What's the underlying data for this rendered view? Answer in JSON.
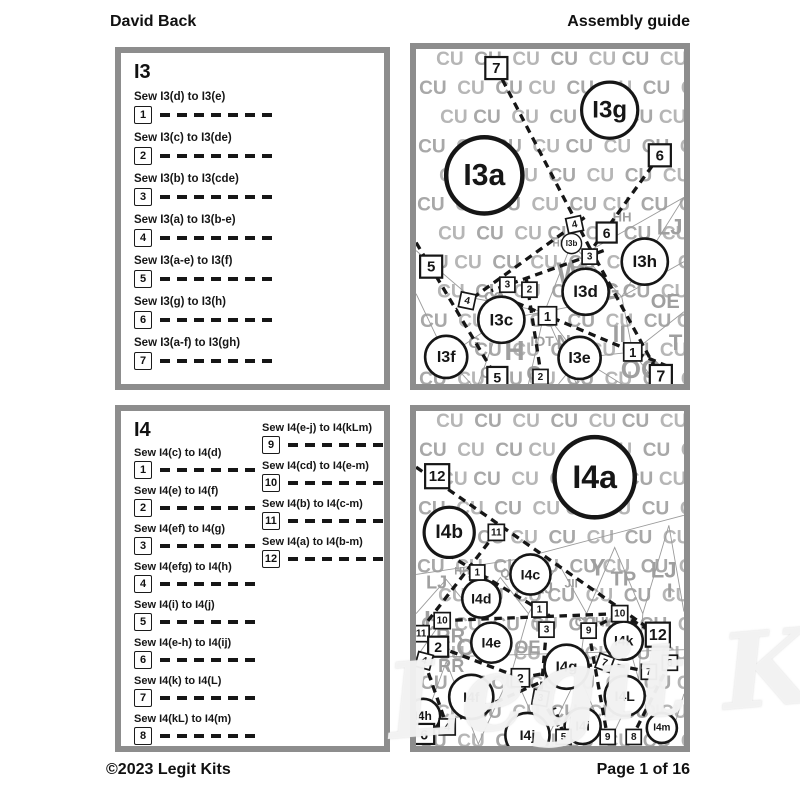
{
  "header": {
    "left": "David Back",
    "right": "Assembly guide"
  },
  "footer": {
    "left": "©2023 Legit Kits",
    "right": "Page 1 of 16"
  },
  "watermark": "Legit Kits",
  "i3": {
    "title": "I3",
    "steps": [
      {
        "num": "1",
        "text": "Sew I3(d) to I3(e)"
      },
      {
        "num": "2",
        "text": "Sew I3(c) to I3(de)"
      },
      {
        "num": "3",
        "text": "Sew I3(b) to I3(cde)"
      },
      {
        "num": "4",
        "text": "Sew I3(a) to I3(b-e)"
      },
      {
        "num": "5",
        "text": "Sew I3(a-e) to I3(f)"
      },
      {
        "num": "6",
        "text": "Sew I3(g) to I3(h)"
      },
      {
        "num": "7",
        "text": "Sew I3(a-f) to I3(gh)"
      }
    ]
  },
  "i4": {
    "title": "I4",
    "steps_left": [
      {
        "num": "1",
        "text": "Sew I4(c) to I4(d)"
      },
      {
        "num": "2",
        "text": "Sew I4(e) to I4(f)"
      },
      {
        "num": "3",
        "text": "Sew I4(ef) to I4(g)"
      },
      {
        "num": "4",
        "text": "Sew I4(efg) to I4(h)"
      },
      {
        "num": "5",
        "text": "Sew I4(i) to I4(j)"
      },
      {
        "num": "6",
        "text": "Sew I4(e-h) to I4(ij)"
      },
      {
        "num": "7",
        "text": "Sew I4(k) to I4(L)"
      },
      {
        "num": "8",
        "text": "Sew I4(kL) to I4(m)"
      }
    ],
    "steps_right": [
      {
        "num": "9",
        "text": "Sew I4(e-j) to I4(kLm)"
      },
      {
        "num": "10",
        "text": "Sew I4(cd) to I4(e-m)"
      },
      {
        "num": "11",
        "text": "Sew I4(b) to I4(c-m)"
      },
      {
        "num": "12",
        "text": "Sew I4(a) to I4(b-m)"
      }
    ]
  },
  "i3_diagram": {
    "bg_letter": "CU",
    "scatter": [
      {
        "t": "HH",
        "x": 196,
        "y": 172,
        "fs": 13
      },
      {
        "t": "LJ",
        "x": 240,
        "y": 185,
        "fs": 22
      },
      {
        "t": "HH",
        "x": 136,
        "y": 197,
        "fs": 10
      },
      {
        "t": "W",
        "x": 140,
        "y": 234,
        "fs": 30
      },
      {
        "t": "CO",
        "x": 68,
        "y": 251,
        "fs": 13
      },
      {
        "t": "G",
        "x": 186,
        "y": 249,
        "fs": 22
      },
      {
        "t": "OE",
        "x": 234,
        "y": 258,
        "fs": 20
      },
      {
        "t": "II",
        "x": 196,
        "y": 292,
        "fs": 24
      },
      {
        "t": "IOT",
        "x": 114,
        "y": 296,
        "fs": 14
      },
      {
        "t": "N",
        "x": 140,
        "y": 299,
        "fs": 20
      },
      {
        "t": "T",
        "x": 252,
        "y": 300,
        "fs": 22
      },
      {
        "t": "G",
        "x": 52,
        "y": 298,
        "fs": 16
      },
      {
        "t": "H",
        "x": 88,
        "y": 310,
        "fs": 28
      },
      {
        "t": "CF",
        "x": 64,
        "y": 328,
        "fs": 16
      },
      {
        "t": "Q",
        "x": 110,
        "y": 330,
        "fs": 20
      },
      {
        "t": "OO",
        "x": 204,
        "y": 328,
        "fs": 26
      }
    ],
    "edges": [
      [
        [
          0,
          201
        ],
        [
          55,
          248
        ],
        [
          128,
          262
        ],
        [
          205,
          247
        ],
        [
          267,
          148
        ]
      ],
      [
        [
          0,
          244
        ],
        [
          30,
          307
        ],
        [
          55,
          334
        ]
      ],
      [
        [
          30,
          307
        ],
        [
          85,
          270
        ]
      ],
      [
        [
          85,
          270
        ],
        [
          62,
          334
        ]
      ],
      [
        [
          85,
          270
        ],
        [
          128,
          262
        ]
      ],
      [
        [
          128,
          262
        ],
        [
          112,
          334
        ]
      ],
      [
        [
          128,
          262
        ],
        [
          160,
          334
        ]
      ],
      [
        [
          128,
          262
        ],
        [
          163,
          308
        ]
      ],
      [
        [
          163,
          308
        ],
        [
          142,
          334
        ]
      ],
      [
        [
          163,
          308
        ],
        [
          205,
          334
        ]
      ],
      [
        [
          163,
          308
        ],
        [
          216,
          302
        ]
      ],
      [
        [
          205,
          247
        ],
        [
          216,
          302
        ]
      ],
      [
        [
          216,
          302
        ],
        [
          240,
          334
        ]
      ],
      [
        [
          216,
          302
        ],
        [
          267,
          262
        ]
      ],
      [
        [
          205,
          247
        ],
        [
          267,
          212
        ]
      ],
      [
        [
          155,
          194
        ],
        [
          205,
          247
        ]
      ],
      [
        [
          155,
          194
        ],
        [
          128,
          262
        ]
      ],
      [
        [
          175,
          200
        ],
        [
          267,
          148
        ]
      ]
    ],
    "seams": [
      [
        [
          80,
          19
        ],
        [
          173,
          198
        ]
      ],
      [
        [
          173,
          198
        ],
        [
          244,
          328
        ]
      ],
      [
        [
          243,
          106
        ],
        [
          175,
          200
        ]
      ],
      [
        [
          0,
          193
        ],
        [
          81,
          329
        ]
      ],
      [
        [
          168,
          168
        ],
        [
          40,
          260
        ]
      ],
      [
        [
          187,
          201
        ],
        [
          75,
          241
        ]
      ],
      [
        [
          110,
          230
        ],
        [
          126,
          334
        ]
      ],
      [
        [
          100,
          253
        ],
        [
          250,
          316
        ]
      ]
    ],
    "circles": [
      {
        "label": "I3a",
        "x": 68,
        "y": 126,
        "r": 38,
        "fs": 30
      },
      {
        "label": "I3g",
        "x": 193,
        "y": 61,
        "r": 28,
        "fs": 24
      },
      {
        "label": "I3b",
        "x": 155,
        "y": 194,
        "r": 10,
        "fs": 8
      },
      {
        "label": "I3h",
        "x": 228,
        "y": 212,
        "r": 23,
        "fs": 17
      },
      {
        "label": "I3d",
        "x": 169,
        "y": 242,
        "r": 23,
        "fs": 17
      },
      {
        "label": "I3c",
        "x": 85,
        "y": 270,
        "r": 23,
        "fs": 17
      },
      {
        "label": "I3f",
        "x": 30,
        "y": 307,
        "r": 21,
        "fs": 16
      },
      {
        "label": "I3e",
        "x": 163,
        "y": 308,
        "r": 21,
        "fs": 16
      }
    ],
    "squares": [
      {
        "label": "7",
        "x": 80,
        "y": 19,
        "s": 22,
        "fs": 15
      },
      {
        "label": "6",
        "x": 243,
        "y": 106,
        "s": 22,
        "fs": 15
      },
      {
        "label": "5",
        "x": 15,
        "y": 217,
        "s": 22,
        "fs": 15
      },
      {
        "label": "4",
        "x": 158,
        "y": 175,
        "s": 15,
        "fs": 10,
        "rot": -12
      },
      {
        "label": "6",
        "x": 190,
        "y": 183,
        "s": 20,
        "fs": 14
      },
      {
        "label": "3",
        "x": 173,
        "y": 207,
        "s": 15,
        "fs": 10
      },
      {
        "label": "3",
        "x": 91,
        "y": 235,
        "s": 15,
        "fs": 10
      },
      {
        "label": "2",
        "x": 113,
        "y": 240,
        "s": 15,
        "fs": 10
      },
      {
        "label": "4",
        "x": 51,
        "y": 251,
        "s": 15,
        "fs": 10,
        "rot": 12
      },
      {
        "label": "1",
        "x": 131,
        "y": 266,
        "s": 18,
        "fs": 13
      },
      {
        "label": "1",
        "x": 216,
        "y": 302,
        "s": 18,
        "fs": 13
      },
      {
        "label": "2",
        "x": 124,
        "y": 327,
        "s": 15,
        "fs": 10
      },
      {
        "label": "5",
        "x": 81,
        "y": 327,
        "s": 20,
        "fs": 14
      },
      {
        "label": "7",
        "x": 244,
        "y": 326,
        "s": 22,
        "fs": 16
      }
    ]
  },
  "i4_diagram": {
    "bg_letter": "CU",
    "scatter": [
      {
        "t": "HH",
        "x": 38,
        "y": 163,
        "fs": 11
      },
      {
        "t": "QE",
        "x": 84,
        "y": 166,
        "fs": 12
      },
      {
        "t": "W",
        "x": 52,
        "y": 180,
        "fs": 22
      },
      {
        "t": "Y",
        "x": 173,
        "y": 164,
        "fs": 24
      },
      {
        "t": "TP",
        "x": 194,
        "y": 174,
        "fs": 20
      },
      {
        "t": "LJ",
        "x": 234,
        "y": 166,
        "fs": 22
      },
      {
        "t": "LJ",
        "x": 10,
        "y": 177,
        "fs": 18
      },
      {
        "t": "JII",
        "x": 148,
        "y": 176,
        "fs": 12
      },
      {
        "t": "R",
        "x": 68,
        "y": 188,
        "fs": 20
      },
      {
        "t": "LJ",
        "x": 118,
        "y": 182,
        "fs": 16
      },
      {
        "t": "I",
        "x": 8,
        "y": 216,
        "fs": 24
      },
      {
        "t": "RR",
        "x": 20,
        "y": 231,
        "fs": 20
      },
      {
        "t": "OE",
        "x": 40,
        "y": 244,
        "fs": 24
      },
      {
        "t": "TP",
        "x": 116,
        "y": 220,
        "fs": 16
      },
      {
        "t": "CC",
        "x": 158,
        "y": 215,
        "fs": 14
      },
      {
        "t": "HH",
        "x": 178,
        "y": 215,
        "fs": 14
      },
      {
        "t": "RR",
        "x": 22,
        "y": 260,
        "fs": 18
      },
      {
        "t": "OE",
        "x": 98,
        "y": 242,
        "fs": 18
      },
      {
        "t": "RR",
        "x": 148,
        "y": 246,
        "fs": 14
      },
      {
        "t": "Q",
        "x": 194,
        "y": 280,
        "fs": 18
      },
      {
        "t": "OL",
        "x": 228,
        "y": 302,
        "fs": 14
      },
      {
        "t": "I",
        "x": 250,
        "y": 186,
        "fs": 20
      },
      {
        "t": "CO",
        "x": 236,
        "y": 233,
        "fs": 10
      }
    ],
    "edges": [
      [
        [
          0,
          163
        ],
        [
          100,
          148
        ],
        [
          267,
          104
        ]
      ],
      [
        [
          0,
          202
        ],
        [
          30,
          168
        ],
        [
          58,
          202
        ],
        [
          84,
          166
        ],
        [
          112,
          202
        ],
        [
          142,
          152
        ],
        [
          170,
          202
        ],
        [
          198,
          136
        ],
        [
          226,
          202
        ],
        [
          252,
          114
        ],
        [
          267,
          200
        ]
      ],
      [
        [
          0,
          332
        ],
        [
          30,
          250
        ],
        [
          62,
          332
        ],
        [
          96,
          258
        ],
        [
          128,
          332
        ],
        [
          162,
          262
        ],
        [
          192,
          332
        ],
        [
          222,
          268
        ],
        [
          252,
          332
        ],
        [
          267,
          282
        ]
      ],
      [
        [
          0,
          246
        ],
        [
          267,
          238
        ]
      ],
      [
        [
          112,
          202
        ],
        [
          96,
          258
        ]
      ],
      [
        [
          170,
          202
        ],
        [
          162,
          262
        ]
      ],
      [
        [
          226,
          202
        ],
        [
          222,
          268
        ]
      ],
      [
        [
          26,
          209
        ],
        [
          0,
          246
        ]
      ],
      [
        [
          203,
          202
        ],
        [
          222,
          268
        ]
      ]
    ],
    "seams": [
      [
        [
          0,
          56
        ],
        [
          241,
          223
        ]
      ],
      [
        [
          80,
          121
        ],
        [
          2,
          222
        ]
      ],
      [
        [
          26,
          209
        ],
        [
          203,
          202
        ]
      ],
      [
        [
          203,
          202
        ],
        [
          241,
          223
        ]
      ],
      [
        [
          20,
          136
        ],
        [
          133,
          204
        ]
      ],
      [
        [
          172,
          219
        ],
        [
          203,
          202
        ]
      ],
      [
        [
          172,
          219
        ],
        [
          191,
          326
        ]
      ],
      [
        [
          253,
          251
        ],
        [
          217,
          322
        ]
      ],
      [
        [
          188,
          251
        ],
        [
          232,
          260
        ]
      ],
      [
        [
          8,
          322
        ],
        [
          125,
          270
        ]
      ],
      [
        [
          147,
          322
        ],
        [
          138,
          296
        ]
      ],
      [
        [
          8,
          249
        ],
        [
          31,
          315
        ]
      ],
      [
        [
          130,
          218
        ],
        [
          124,
          286
        ]
      ],
      [
        [
          22,
          235
        ],
        [
          104,
          266
        ]
      ],
      [
        [
          104,
          266
        ],
        [
          188,
          251
        ]
      ],
      [
        [
          124,
          286
        ],
        [
          147,
          322
        ]
      ]
    ],
    "circles": [
      {
        "label": "I4a",
        "x": 178,
        "y": 66,
        "r": 40,
        "fs": 32
      },
      {
        "label": "I4b",
        "x": 33,
        "y": 121,
        "r": 25,
        "fs": 19
      },
      {
        "label": "I4c",
        "x": 114,
        "y": 163,
        "r": 20,
        "fs": 14
      },
      {
        "label": "I4d",
        "x": 65,
        "y": 187,
        "r": 19,
        "fs": 14
      },
      {
        "label": "I4e",
        "x": 75,
        "y": 231,
        "r": 20,
        "fs": 14
      },
      {
        "label": "I4f",
        "x": 55,
        "y": 285,
        "r": 22,
        "fs": 14
      },
      {
        "label": "I4g",
        "x": 150,
        "y": 255,
        "r": 22,
        "fs": 15
      },
      {
        "label": "I4h",
        "x": 7,
        "y": 304,
        "r": 17,
        "fs": 12
      },
      {
        "label": "I4i",
        "x": 166,
        "y": 314,
        "r": 18,
        "fs": 13
      },
      {
        "label": "I4j",
        "x": 111,
        "y": 323,
        "r": 22,
        "fs": 14
      },
      {
        "label": "I4k",
        "x": 207,
        "y": 229,
        "r": 19,
        "fs": 14
      },
      {
        "label": "I4L",
        "x": 208,
        "y": 284,
        "r": 20,
        "fs": 14
      },
      {
        "label": "I4m",
        "x": 245,
        "y": 316,
        "r": 15,
        "fs": 10
      }
    ],
    "squares": [
      {
        "label": "12",
        "x": 21,
        "y": 65,
        "s": 24,
        "fs": 15
      },
      {
        "label": "11",
        "x": 80,
        "y": 121,
        "s": 16,
        "fs": 10
      },
      {
        "label": "1",
        "x": 61,
        "y": 161,
        "s": 15,
        "fs": 10
      },
      {
        "label": "1",
        "x": 123,
        "y": 198,
        "s": 15,
        "fs": 10
      },
      {
        "label": "10",
        "x": 26,
        "y": 209,
        "s": 16,
        "fs": 10
      },
      {
        "label": "10",
        "x": 203,
        "y": 202,
        "s": 16,
        "fs": 10
      },
      {
        "label": "11",
        "x": 5,
        "y": 222,
        "s": 16,
        "fs": 10
      },
      {
        "label": "12",
        "x": 241,
        "y": 223,
        "s": 24,
        "fs": 16
      },
      {
        "label": "2",
        "x": 22,
        "y": 235,
        "s": 20,
        "fs": 14
      },
      {
        "label": "3",
        "x": 130,
        "y": 218,
        "s": 15,
        "fs": 10
      },
      {
        "label": "9",
        "x": 172,
        "y": 219,
        "s": 15,
        "fs": 10
      },
      {
        "label": "4",
        "x": 8,
        "y": 249,
        "s": 15,
        "fs": 10,
        "rot": 15
      },
      {
        "label": "8",
        "x": 253,
        "y": 251,
        "s": 15,
        "fs": 10
      },
      {
        "label": "7",
        "x": 188,
        "y": 251,
        "s": 15,
        "fs": 10,
        "rot": 20
      },
      {
        "label": "7",
        "x": 232,
        "y": 260,
        "s": 15,
        "fs": 10
      },
      {
        "label": "2",
        "x": 104,
        "y": 266,
        "s": 18,
        "fs": 12
      },
      {
        "label": "3",
        "x": 124,
        "y": 286,
        "s": 15,
        "fs": 10,
        "rot": 10
      },
      {
        "label": "4",
        "x": 31,
        "y": 315,
        "s": 16,
        "fs": 11
      },
      {
        "label": "6",
        "x": 8,
        "y": 322,
        "s": 20,
        "fs": 14
      },
      {
        "label": "5",
        "x": 147,
        "y": 325,
        "s": 15,
        "fs": 10
      },
      {
        "label": "9",
        "x": 191,
        "y": 325,
        "s": 15,
        "fs": 10
      },
      {
        "label": "8",
        "x": 217,
        "y": 325,
        "s": 15,
        "fs": 10
      }
    ]
  }
}
